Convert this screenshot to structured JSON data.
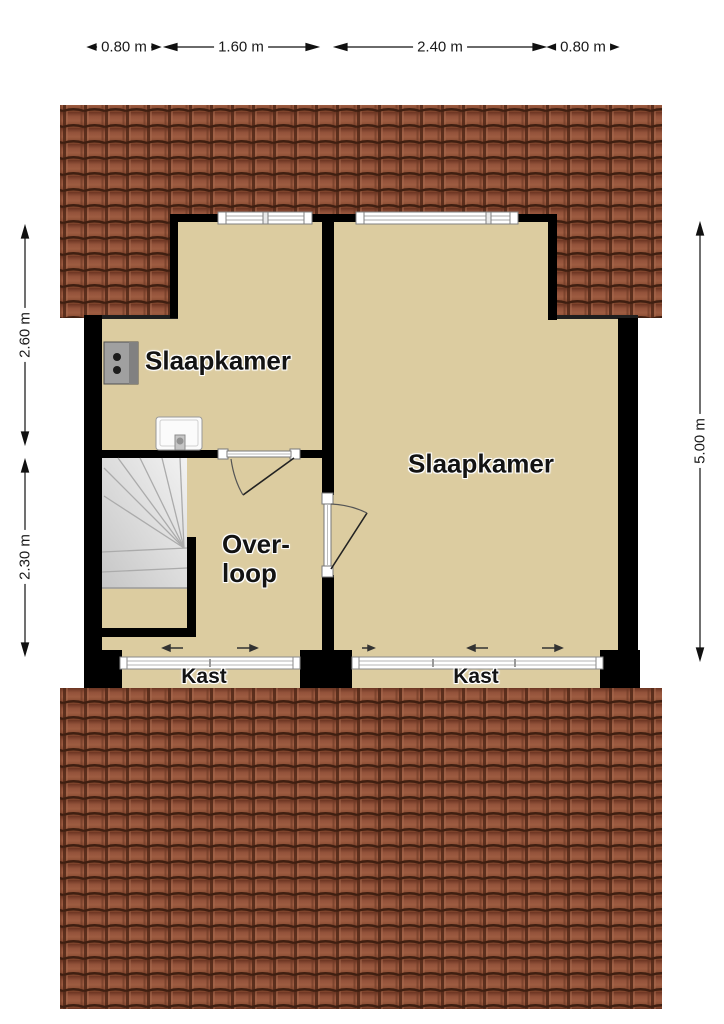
{
  "floorplan": {
    "dimensions_top": [
      {
        "label": "0.80 m"
      },
      {
        "label": "1.60 m"
      },
      {
        "label": "2.40 m"
      },
      {
        "label": "0.80 m"
      }
    ],
    "dimensions_left": [
      {
        "label": "2.60 m"
      },
      {
        "label": "2.30 m"
      }
    ],
    "dimensions_right": [
      {
        "label": "5.00 m"
      }
    ],
    "rooms": {
      "bedroom_left": {
        "label": "Slaapkamer"
      },
      "bedroom_right": {
        "label": "Slaapkamer"
      },
      "landing": {
        "label_line1": "Over-",
        "label_line2": "loop"
      },
      "closet_left": {
        "label": "Kast"
      },
      "closet_right": {
        "label": "Kast"
      }
    },
    "colors": {
      "floor": "#dccca0",
      "wall": "#000000",
      "roof_tile_base": "#8d4b34",
      "roof_tile_dark": "#46251a",
      "roof_tile_light": "#a86a4e",
      "stairs": "#d9d9d9",
      "background": "#ffffff"
    },
    "icons": {
      "heater": "heater-unit-icon",
      "sink": "sink-icon",
      "slide_arrow": "sliding-door-arrow-icon",
      "dimension_arrow": "dimension-arrow-icon"
    }
  }
}
